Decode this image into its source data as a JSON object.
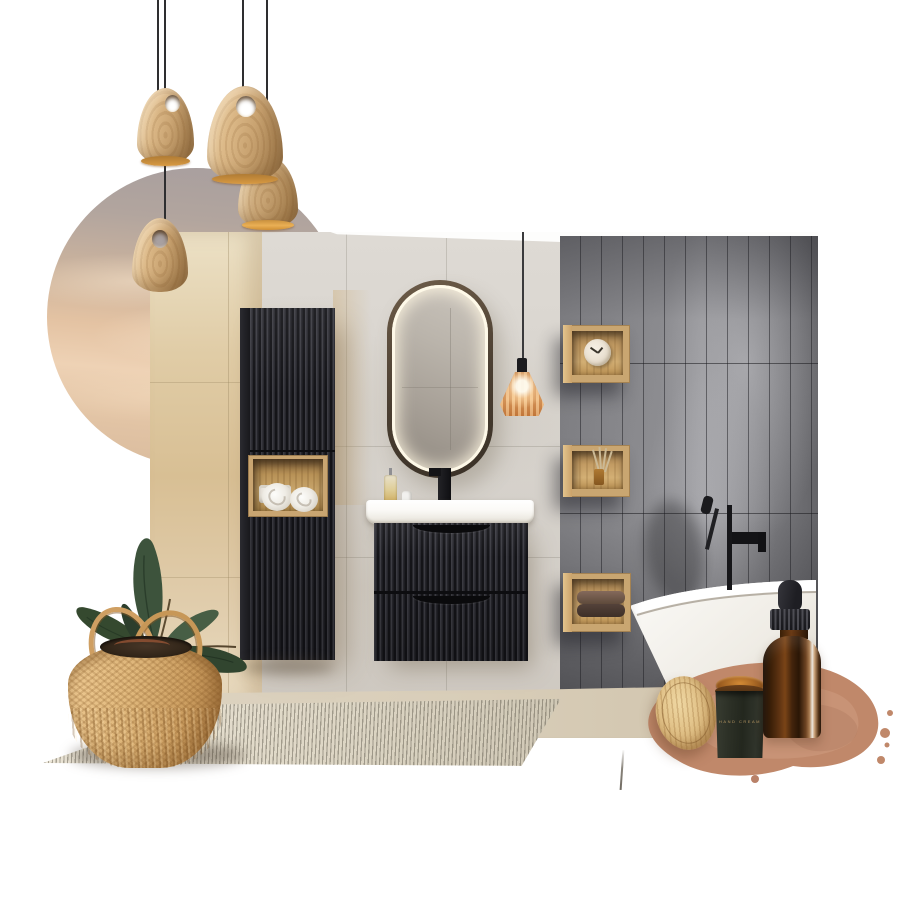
{
  "board": {
    "title": "Bathroom interior moodboard collage",
    "style": "japandi / organic modern",
    "background_color": "#ffffff"
  },
  "collage_items": [
    {
      "name": "wood-pendant-lights",
      "count": 4,
      "description": "Egg-shaped light ash wood pendant lamps on thin black cords, glowing amber inside, each with a round cutout near the top"
    },
    {
      "name": "sunset-sky-circle",
      "description": "Circular crop of a soft peach and grey-mauve evening sky with hazy clouds"
    },
    {
      "name": "bathroom-photo",
      "description": "Bathroom render: light concrete tile wall, warm beige side wall, glossy graphite vertical subway-tile wall, beige floor"
    },
    {
      "name": "tall-fluted-cabinet",
      "description": "Wall-hung black fluted tall cabinet with open oak niche holding rolled white towels"
    },
    {
      "name": "led-oval-mirror",
      "description": "Pill-shaped mirror with dark bronze frame and warm white LED halo"
    },
    {
      "name": "amber-glass-pendant",
      "description": "Small faceted amber glass pendant light, lit, hanging beside the mirror"
    },
    {
      "name": "black-fluted-vanity",
      "description": "Wall-hung two-drawer black fluted vanity with white countertop basin, black tall basin mixer, soap bottle and white tube"
    },
    {
      "name": "oak-cube-shelf-clock",
      "description": "Oak cube wall shelf with round cream alarm clock"
    },
    {
      "name": "oak-cube-shelf-diffuser",
      "description": "Oak cube wall shelf with reed diffuser"
    },
    {
      "name": "oak-cube-shelf-towels",
      "description": "Oak cube wall shelf with folded brown towels"
    },
    {
      "name": "freestanding-bathtub",
      "description": "White freestanding bathtub with matte black floor-mounted tub filler"
    },
    {
      "name": "striped-rug",
      "description": "Flatweave rug with fine cream and grey vertical stripes, shown in perspective"
    },
    {
      "name": "rubber-plant-in-basket",
      "description": "Ficus elastica with dark green leaves in a natural seagrass belly basket with two loop handles"
    },
    {
      "name": "terracotta-watercolor-swatch",
      "description": "Organic clay / terracotta watercolor paint splash with splatter edges"
    },
    {
      "name": "amber-jar-wood-lid",
      "description": "Amber glass cosmetic jar with dark label and leaning natural wood lid"
    },
    {
      "name": "amber-dropper-bottle",
      "description": "Amber glass dropper bottle with black rubber bulb and ridged cap"
    }
  ],
  "products": {
    "jar_label": "HAND CREAM"
  },
  "palette": {
    "background": "#ffffff",
    "wood_light": "#d9b586",
    "oak": "#c9a671",
    "black_matte": "#212126",
    "concrete_tile": "#d7d3cd",
    "beige_wall": "#dcc49c",
    "graphite_tile": "#7e7e82",
    "amber_glass": "#d68d4f",
    "terracotta_splash": "#c0886a",
    "rug_cream": "#e6e0d1",
    "leaf_green": "#3d533c",
    "basket_tan": "#dcb277",
    "sky_peach": "#e9cdaf",
    "sky_grey": "#a79e9f",
    "tub_white": "#f9f7f3"
  }
}
